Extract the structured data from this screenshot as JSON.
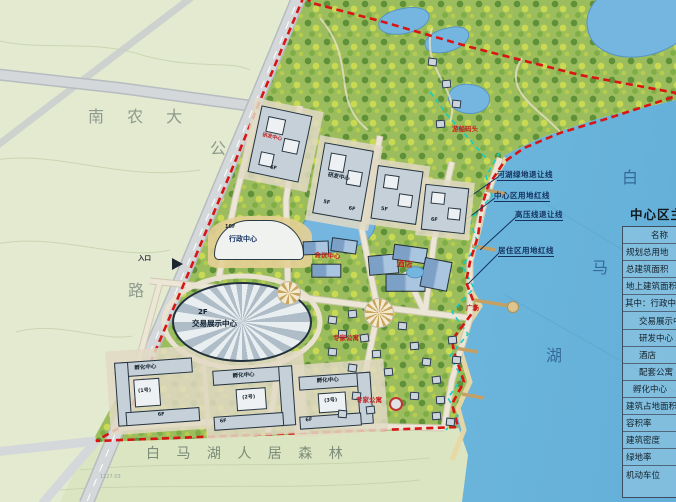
{
  "colors": {
    "boundary_red": "#d81414",
    "setback_cyan": "#12cfc4",
    "label_red": "#c32222",
    "annotation_navy": "#14325e",
    "lake_blue": "#74bce0",
    "field_green": "#e3ead0",
    "park_green": "#9cbd5e"
  },
  "region_labels": {
    "university": "南 农 大",
    "road_char_1": "公",
    "road_char_2": "路",
    "forest": "白 马 湖 人 居 森 林",
    "lake_char_1": "白",
    "lake_char_2": "马",
    "lake_char_3": "湖",
    "entrance": "入口",
    "survey_mark": "1127.03"
  },
  "annotations": [
    "河湖绿地退让线",
    "中心区用地红线",
    "高压线退让线",
    "居住区用地红线"
  ],
  "buildings": {
    "admin": {
      "floors": "10F",
      "label": "行政中心"
    },
    "exhibition": {
      "floors": "2F",
      "label": "交易展示中心"
    },
    "rnd": {
      "label": "研发中心",
      "floors_5f": "5F",
      "floors_6f": "6F"
    },
    "conference": {
      "label": "会议中心"
    },
    "hotel": {
      "label": "酒店"
    },
    "incubator1": {
      "label": "孵化中心",
      "unit": "(1号)",
      "floors": "6F"
    },
    "incubator2": {
      "label": "孵化中心",
      "unit": "(2号)",
      "floors": "6F"
    },
    "incubator3": {
      "label": "孵化中心",
      "unit": "(3号)",
      "floors": "6F"
    },
    "apartments": {
      "label": "专家公寓"
    },
    "marina": {
      "label": "游船码头"
    },
    "plaza": {
      "label": "广场"
    }
  },
  "legend": {
    "title": "中心区主要经济技术指标",
    "rows": [
      "名称",
      "规划总用地",
      "总建筑面积",
      "地上建筑面积",
      "其中：行政中心",
      "交易展示中心",
      "研发中心",
      "酒店",
      "配套公寓",
      "孵化中心",
      "建筑占地面积",
      "容积率",
      "建筑密度",
      "绿地率",
      "机动车位"
    ]
  }
}
